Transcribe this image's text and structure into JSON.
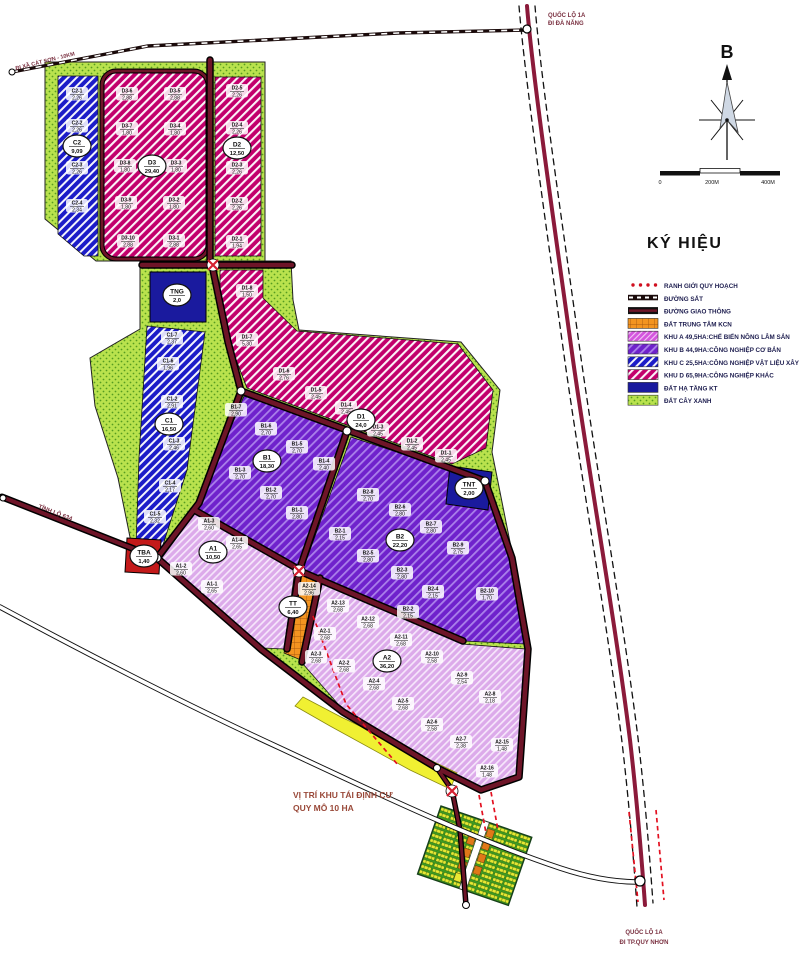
{
  "legend": {
    "title": "KÝ HIỆU",
    "items": [
      {
        "label": "RANH GIỚI QUY HOẠCH",
        "swatch": "boundary"
      },
      {
        "label": "ĐƯỜNG SẮT",
        "swatch": "railway"
      },
      {
        "label": "ĐƯỜNG GIAO THÔNG",
        "swatch": "road"
      },
      {
        "label": "ĐẤT TRUNG TÂM KCN",
        "swatch": "center"
      },
      {
        "label": "KHU A 49,5HA:CHẾ BIẾN NÔNG LÂM SẢN",
        "swatch": "zoneA"
      },
      {
        "label": "KHU B 44,9HA:CÔNG NGHIỆP CƠ BẢN",
        "swatch": "zoneB"
      },
      {
        "label": "KHU C 25,5HA:CÔNG NGHIỆP VẬT LIỆU XÂY DỰNG",
        "swatch": "zoneC"
      },
      {
        "label": "KHU D 65,9HA:CÔNG NGHIỆP KHÁC",
        "swatch": "zoneD"
      },
      {
        "label": "ĐẤT HẠ TẦNG KT",
        "swatch": "infra"
      },
      {
        "label": "ĐẤT CÂY XANH",
        "swatch": "green"
      }
    ]
  },
  "compass": {
    "label": "B"
  },
  "scalebar": {
    "zero": "0",
    "mid": "200M",
    "end": "400M"
  },
  "roads": {
    "ql1a_north": {
      "line1": "QUỐC LỘ 1A",
      "line2": "ĐI ĐÀ NẴNG"
    },
    "ql1a_south": {
      "line1": "QUỐC LỘ 1A",
      "line2": "ĐI TP.QUY NHƠN"
    },
    "tl634": {
      "label": "TỈNH LỘ 634"
    },
    "cat_son": {
      "label": "ĐI XÃ CÁT SƠN - 10KM"
    }
  },
  "annotation": {
    "line1": "VỊ TRÍ KHU TÁI ĐỊNH CƯ",
    "line2": "QUY MÔ 10 HA"
  },
  "zones": [
    {
      "id": "C2",
      "area": "9,09",
      "x": 77,
      "y": 146
    },
    {
      "id": "D3",
      "area": "29,40",
      "x": 152,
      "y": 166
    },
    {
      "id": "D2",
      "area": "12,50",
      "x": 237,
      "y": 148
    },
    {
      "id": "TNG",
      "area": "2,0",
      "x": 177,
      "y": 295
    },
    {
      "id": "C1",
      "area": "16,50",
      "x": 169,
      "y": 424
    },
    {
      "id": "D1",
      "area": "24,0",
      "x": 361,
      "y": 420
    },
    {
      "id": "B1",
      "area": "18,30",
      "x": 267,
      "y": 461
    },
    {
      "id": "B2",
      "area": "22,20",
      "x": 400,
      "y": 540
    },
    {
      "id": "TNT",
      "area": "2,00",
      "x": 469,
      "y": 488
    },
    {
      "id": "TBA",
      "area": "1,40",
      "x": 144,
      "y": 556
    },
    {
      "id": "A1",
      "area": "10,50",
      "x": 213,
      "y": 552
    },
    {
      "id": "TT",
      "area": "6,40",
      "x": 293,
      "y": 607
    },
    {
      "id": "A2",
      "area": "36,20",
      "x": 387,
      "y": 661
    }
  ],
  "parcels": [
    {
      "id": "C2-1",
      "area": "2,26",
      "x": 77,
      "y": 94
    },
    {
      "id": "C2-2",
      "area": "2,26",
      "x": 77,
      "y": 126
    },
    {
      "id": "C2-3",
      "area": "2,26",
      "x": 77,
      "y": 168
    },
    {
      "id": "C2-4",
      "area": "2,34",
      "x": 77,
      "y": 206
    },
    {
      "id": "D3-6",
      "area": "2,88",
      "x": 127,
      "y": 94
    },
    {
      "id": "D3-5",
      "area": "2,88",
      "x": 175,
      "y": 94
    },
    {
      "id": "D3-7",
      "area": "1,80",
      "x": 127,
      "y": 129
    },
    {
      "id": "D3-4",
      "area": "1,80",
      "x": 175,
      "y": 129
    },
    {
      "id": "D3-8",
      "area": "1,80",
      "x": 125,
      "y": 166
    },
    {
      "id": "D3-3",
      "area": "1,80",
      "x": 176,
      "y": 166
    },
    {
      "id": "D3-9",
      "area": "1,80",
      "x": 126,
      "y": 203
    },
    {
      "id": "D3-2",
      "area": "1,80",
      "x": 174,
      "y": 203
    },
    {
      "id": "D3-10",
      "area": "2,88",
      "x": 128,
      "y": 241
    },
    {
      "id": "D3-1",
      "area": "2,88",
      "x": 174,
      "y": 241
    },
    {
      "id": "D2-5",
      "area": "2,26",
      "x": 237,
      "y": 91
    },
    {
      "id": "D2-4",
      "area": "2,26",
      "x": 237,
      "y": 128
    },
    {
      "id": "D2-3",
      "area": "2,26",
      "x": 237,
      "y": 168
    },
    {
      "id": "D2-2",
      "area": "2,26",
      "x": 237,
      "y": 204
    },
    {
      "id": "D2-1",
      "area": "1,94",
      "x": 237,
      "y": 242
    },
    {
      "id": "D1-8",
      "area": "1,50",
      "x": 247,
      "y": 291
    },
    {
      "id": "D1-7",
      "area": "5,30",
      "x": 247,
      "y": 340
    },
    {
      "id": "D1-6",
      "area": "2,76",
      "x": 284,
      "y": 374
    },
    {
      "id": "D1-5",
      "area": "2,45",
      "x": 316,
      "y": 393
    },
    {
      "id": "D1-4",
      "area": "2,45",
      "x": 346,
      "y": 408
    },
    {
      "id": "D1-3",
      "area": "2,45",
      "x": 378,
      "y": 430
    },
    {
      "id": "D1-2",
      "area": "2,45",
      "x": 412,
      "y": 444
    },
    {
      "id": "D1-1",
      "area": "2,45",
      "x": 446,
      "y": 456
    },
    {
      "id": "C1-7",
      "area": "2,37",
      "x": 172,
      "y": 338
    },
    {
      "id": "C1-6",
      "area": "1,96",
      "x": 168,
      "y": 364
    },
    {
      "id": "C1-2",
      "area": "2,91",
      "x": 172,
      "y": 402
    },
    {
      "id": "C1-3",
      "area": "2,46",
      "x": 174,
      "y": 444
    },
    {
      "id": "C1-4",
      "area": "2,17",
      "x": 170,
      "y": 486
    },
    {
      "id": "C1-5",
      "area": "2,32",
      "x": 155,
      "y": 517
    },
    {
      "id": "B1-7",
      "area": "2,90",
      "x": 236,
      "y": 410
    },
    {
      "id": "B1-6",
      "area": "2,70",
      "x": 266,
      "y": 429
    },
    {
      "id": "B1-5",
      "area": "2,70",
      "x": 297,
      "y": 447
    },
    {
      "id": "B1-4",
      "area": "2,40",
      "x": 324,
      "y": 464
    },
    {
      "id": "B1-3",
      "area": "2,70",
      "x": 240,
      "y": 473
    },
    {
      "id": "B1-2",
      "area": "2,70",
      "x": 271,
      "y": 493
    },
    {
      "id": "B1-1",
      "area": "2,80",
      "x": 297,
      "y": 513
    },
    {
      "id": "B2-8",
      "area": "2,70",
      "x": 368,
      "y": 495
    },
    {
      "id": "B2-6",
      "area": "2,80",
      "x": 400,
      "y": 510
    },
    {
      "id": "B2-7",
      "area": "2,80",
      "x": 431,
      "y": 527
    },
    {
      "id": "B2-5",
      "area": "2,80",
      "x": 368,
      "y": 556
    },
    {
      "id": "B2-9",
      "area": "2,75",
      "x": 458,
      "y": 548
    },
    {
      "id": "B2-3",
      "area": "2,80",
      "x": 402,
      "y": 573
    },
    {
      "id": "B2-4",
      "area": "2,15",
      "x": 433,
      "y": 592
    },
    {
      "id": "B2-10",
      "area": "1,70",
      "x": 487,
      "y": 594
    },
    {
      "id": "B2-2",
      "area": "2,15",
      "x": 408,
      "y": 612
    },
    {
      "id": "B2-1",
      "area": "2,15",
      "x": 340,
      "y": 534
    },
    {
      "id": "A1-3",
      "area": "2,60",
      "x": 209,
      "y": 524
    },
    {
      "id": "A1-4",
      "area": "2,65",
      "x": 237,
      "y": 543
    },
    {
      "id": "A1-2",
      "area": "2,60",
      "x": 181,
      "y": 569
    },
    {
      "id": "A1-1",
      "area": "2,65",
      "x": 212,
      "y": 587
    },
    {
      "id": "A2-14",
      "area": "2,96",
      "x": 309,
      "y": 589
    },
    {
      "id": "A2-13",
      "area": "2,68",
      "x": 338,
      "y": 606
    },
    {
      "id": "A2-12",
      "area": "2,68",
      "x": 368,
      "y": 622
    },
    {
      "id": "A2-11",
      "area": "2,68",
      "x": 401,
      "y": 640
    },
    {
      "id": "A2-10",
      "area": "2,58",
      "x": 432,
      "y": 657
    },
    {
      "id": "A2-9",
      "area": "2,54",
      "x": 462,
      "y": 678
    },
    {
      "id": "A2-8",
      "area": "2,18",
      "x": 490,
      "y": 697
    },
    {
      "id": "A2-1",
      "area": "2,68",
      "x": 325,
      "y": 634
    },
    {
      "id": "A2-3",
      "area": "2,68",
      "x": 316,
      "y": 657
    },
    {
      "id": "A2-2",
      "area": "2,68",
      "x": 344,
      "y": 666
    },
    {
      "id": "A2-4",
      "area": "2,68",
      "x": 374,
      "y": 684
    },
    {
      "id": "A2-5",
      "area": "2,68",
      "x": 403,
      "y": 704
    },
    {
      "id": "A2-6",
      "area": "2,58",
      "x": 432,
      "y": 725
    },
    {
      "id": "A2-7",
      "area": "2,38",
      "x": 461,
      "y": 742
    },
    {
      "id": "A2-15",
      "area": "1,48",
      "x": 502,
      "y": 745
    },
    {
      "id": "A2-16",
      "area": "1,48",
      "x": 487,
      "y": 771
    }
  ],
  "colors": {
    "zone_a": "#dcaaea",
    "zone_b": "#6f22cc",
    "zone_c": "#1c1cc8",
    "zone_d": "#c2006c",
    "infra_blue": "#1a1a9e",
    "kcn_center_orange": "#f39420",
    "green_land": "#b9e24d",
    "road_maroon": "#6e1528",
    "boundary_red": "#e31020",
    "yellow_strip": "#f0f032",
    "tba_red": "#c41a1a"
  }
}
